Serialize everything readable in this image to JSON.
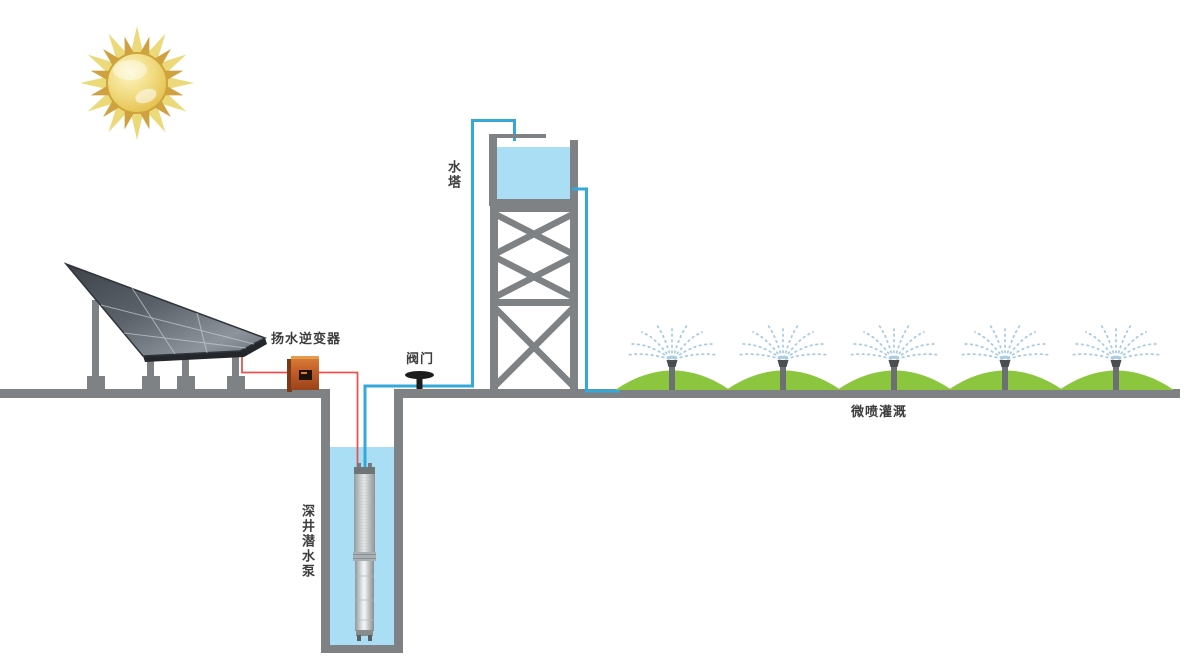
{
  "diagram": {
    "labels": {
      "inverter": "扬水逆变器",
      "valve": "阀门",
      "water_tower": "水塔",
      "submersible_pump": "深井潜水泵",
      "irrigation": "微喷灌溉"
    },
    "components": [
      "sun",
      "solar-panel-array",
      "pump-inverter",
      "dc-wire",
      "valve",
      "well",
      "submersible-pump",
      "water-pipe",
      "water-tower",
      "storage-tank",
      "irrigated-field",
      "micro-sprinklers",
      "ground"
    ],
    "colors": {
      "water": "#a9def5",
      "pipe": "#35a8da",
      "wire": "#e8534f",
      "ground_gray": "#7f8285",
      "field_green": "#8cc63e",
      "spray_blue": "#a9cce2",
      "inverter_orange": "#c05b28",
      "sun_gold": "#e9c24a",
      "label_text": "#3d3d3d"
    }
  }
}
